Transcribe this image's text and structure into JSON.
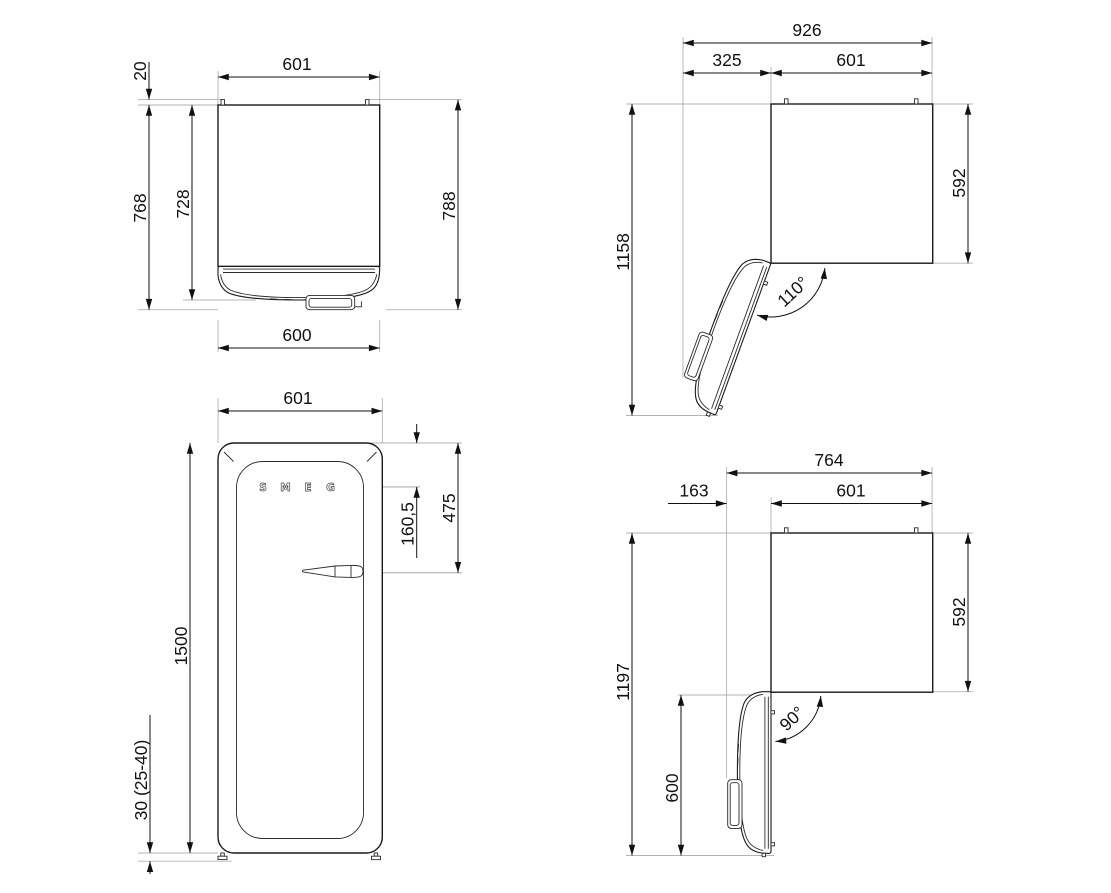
{
  "drawing_title": "refrigerator-dimension-drawing",
  "colors": {
    "line": "#1a1a1a",
    "dim": "#111111",
    "extension": "#b3b3b3",
    "background": "#ffffff"
  },
  "units": "mm",
  "views": {
    "top_closed": {
      "name": "top view door closed",
      "width_top": "601",
      "hinge_clearance": "20",
      "depth_with_handle": "768",
      "depth_door": "728",
      "depth_total": "788",
      "width_bottom": "600"
    },
    "top_open_110": {
      "name": "top view door open 110",
      "width_total": "926",
      "door_swing": "325",
      "width": "601",
      "depth_total": "1158",
      "depth_body": "592",
      "angle": "110°"
    },
    "front": {
      "name": "front view",
      "width": "601",
      "handle_from_top": "475",
      "logo_from_top": "160,5",
      "height": "1500",
      "feet_height": "30 (25-40)",
      "logo": [
        "S",
        "M",
        "E",
        "G"
      ]
    },
    "top_open_90": {
      "name": "top view door open 90",
      "width_total": "764",
      "door_projection": "163",
      "width": "601",
      "depth_total": "1197",
      "depth_body": "592",
      "door_extension": "600",
      "angle": "90°"
    }
  }
}
